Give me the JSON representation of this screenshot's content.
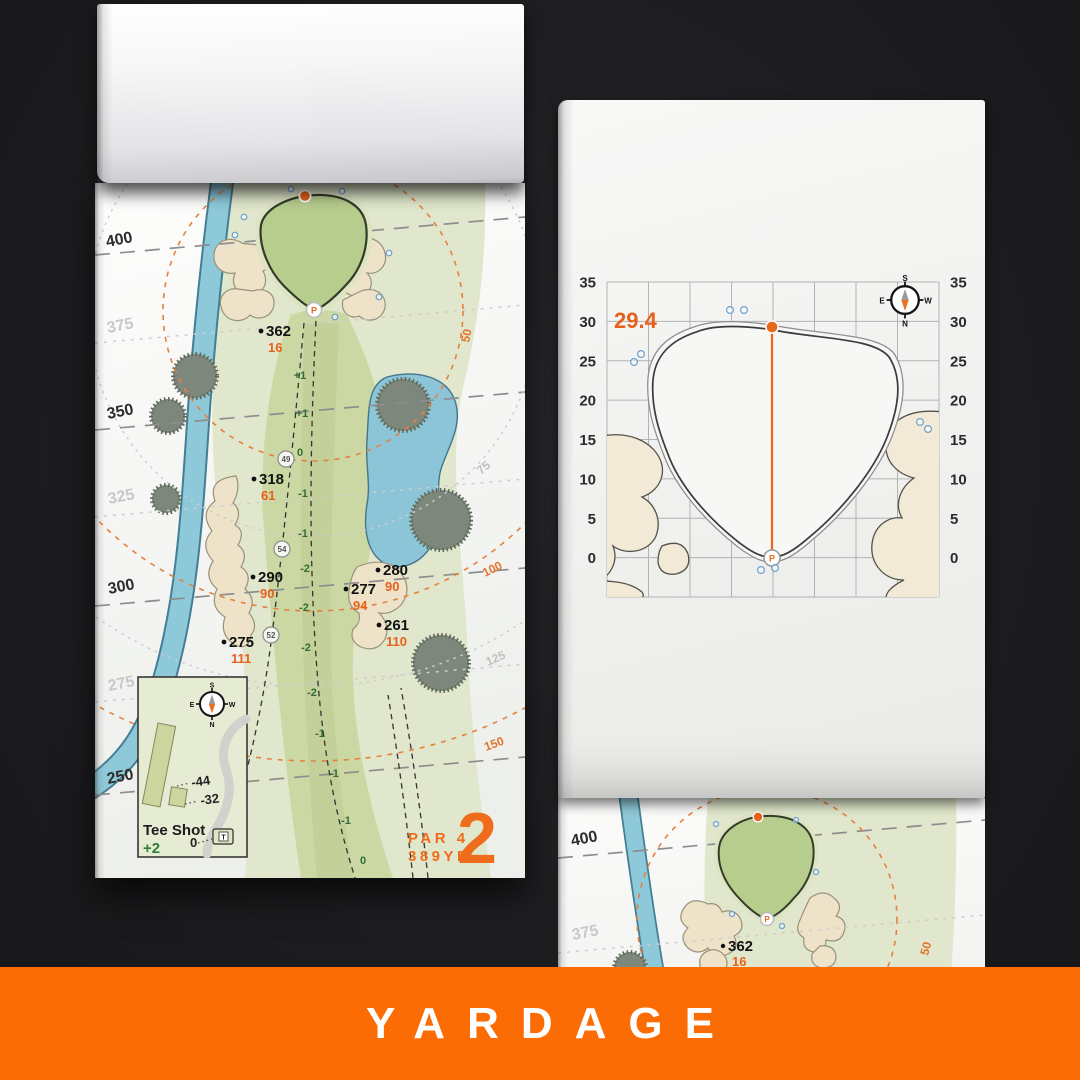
{
  "banner": {
    "label": "YARDAGE",
    "bg_color": "#fb6c05",
    "text_color": "#ffffff"
  },
  "hole_page": {
    "hole_number": "2",
    "par_label": "PAR 4",
    "distance_label": "389YD",
    "left_distance_labels": [
      "400",
      "375",
      "350",
      "325",
      "300",
      "275",
      "250"
    ],
    "arc_labels": [
      "50",
      "75",
      "100",
      "125",
      "150"
    ],
    "elevations": [
      "+1",
      "+1",
      "0",
      "-1",
      "-1",
      "-2",
      "-2",
      "-2",
      "-2",
      "-1",
      "-1",
      "-1",
      "0"
    ],
    "circled_numbers": [
      "49",
      "54",
      "52"
    ],
    "points": [
      {
        "dist": "362",
        "to_green": "16"
      },
      {
        "dist": "318",
        "to_green": "61"
      },
      {
        "dist": "290",
        "to_green": "90"
      },
      {
        "dist": "280",
        "to_green": "90"
      },
      {
        "dist": "277",
        "to_green": "94"
      },
      {
        "dist": "261",
        "to_green": "110"
      },
      {
        "dist": "275",
        "to_green": "111"
      }
    ],
    "tee_inset": {
      "title": "Tee Shot",
      "handicap": "+2",
      "leader_labels": [
        "-44",
        "-32",
        "0"
      ],
      "tee_marker": "T"
    },
    "compass": {
      "n": "N",
      "s": "S",
      "e": "E",
      "w": "W"
    },
    "pin_label": "P",
    "accent_color": "#ee6c1a"
  },
  "green_page": {
    "depth_value": "29.4",
    "axis_ticks": [
      "35",
      "30",
      "25",
      "20",
      "15",
      "10",
      "5",
      "0"
    ],
    "pin_label": "P",
    "compass": {
      "n": "N",
      "s": "S",
      "e": "E",
      "w": "W"
    }
  },
  "next_page": {
    "left_distance_labels": [
      "400",
      "375"
    ],
    "arc_label": "50",
    "point": {
      "dist": "362",
      "to_green": "16"
    },
    "pin_label": "P"
  },
  "chart_data": {
    "type": "scatter",
    "title": "Green depth grid (hole 2)",
    "axis_range": [
      0,
      35
    ],
    "grid_step": 5,
    "green_depth": 29.4,
    "pin_front_value": 0,
    "back_edge_value": 29.4,
    "tick_labels": [
      "35",
      "30",
      "25",
      "20",
      "15",
      "10",
      "5",
      "0"
    ],
    "legend_position": "none",
    "grid": true
  }
}
